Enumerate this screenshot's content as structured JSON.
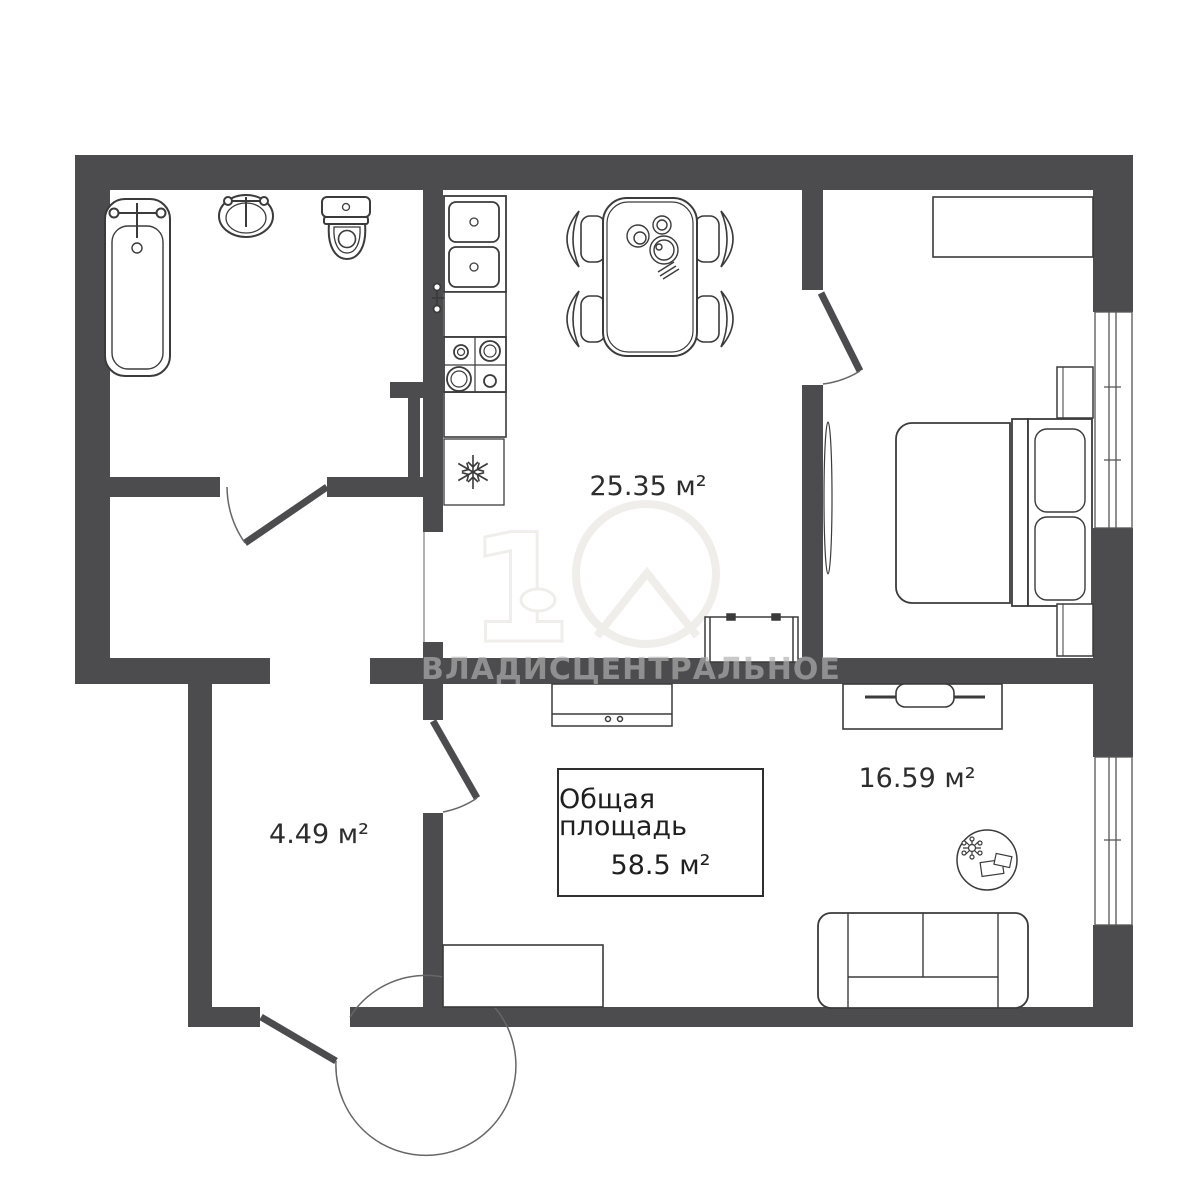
{
  "plan": {
    "labels": {
      "kitchen_area": "25.35 м²",
      "living_area": "16.59 м²",
      "hall_area": "4.49 м²"
    },
    "total": {
      "title": "Общая площадь",
      "value": "58.5 м²"
    },
    "watermark": "ВЛАДИСЦЕНТРАЛЬНОЕ",
    "logo_digit": "1"
  },
  "colors": {
    "wall": "#4c4c4e",
    "outline": "#3b3b3b",
    "label_text": "#2d2d2d",
    "watermark_text": "rgba(175,175,175,0.68)",
    "logo_stroke": "#f0eeea"
  },
  "icons": [
    "snowflake-icon",
    "faucet-icon",
    "plant-icon",
    "house-logo-icon"
  ]
}
